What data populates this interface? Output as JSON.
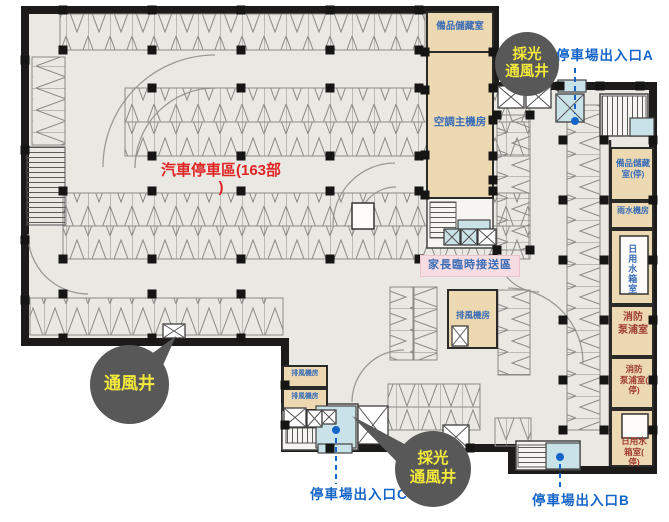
{
  "colors": {
    "wall": "#1d1b19",
    "floor": "#eae8e3",
    "room_tan": "#ecd9b2",
    "room_teal": "#c9e2e8",
    "room_pink": "#f7dce2",
    "label_blue": "#3a6db6",
    "label_red_dark": "#a03c32",
    "accent_red": "#e02525",
    "entrance_blue": "#1565c8",
    "callout_bg": "#585858",
    "callout_text": "#f3e93c"
  },
  "rooms": {
    "storage_top": "備品儲藏室",
    "hvac": "空調主機房",
    "storage_parking": "備品儲藏\n室(停)",
    "rainwater": "雨水機房",
    "daily_water": "日用水箱室",
    "fire_pump": "消防\n泵浦室",
    "fire_pump_parking": "消防\n泵浦室(\n停)",
    "daily_water_parking": "日用水\n箱室(\n停)",
    "exhaust_mid": "排風機房",
    "exhaust_bottom_1": "排風機房",
    "exhaust_bottom_2": "排風機房",
    "dropoff": "家長臨時接送區"
  },
  "annotations": {
    "parking_area": "汽車停車區(163部\n)",
    "vent_shaft": "通風井",
    "light_vent_top": "採光\n通風井",
    "light_vent_bottom": "採光\n通風井"
  },
  "entrances": {
    "a": "停車場出入口A",
    "b": "停車場出入口B",
    "c": "停車場出入口C"
  }
}
